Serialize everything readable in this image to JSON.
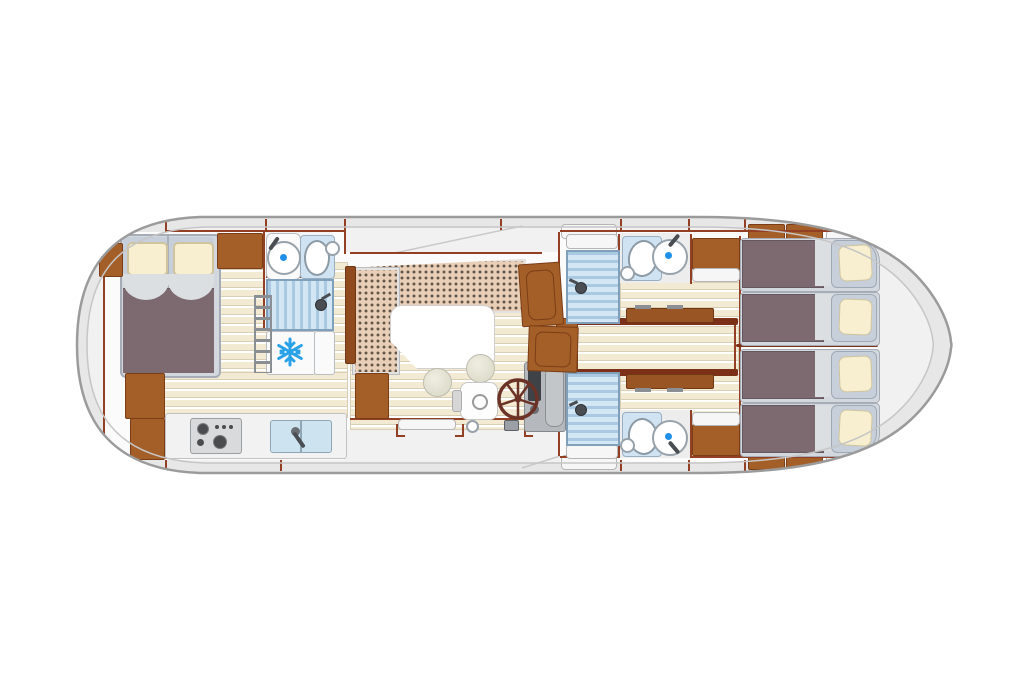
{
  "diagram": {
    "type": "boat-floor-plan",
    "title": "River cruiser interior deck plan (top view)",
    "orientation": "bow at right (pointed), stern at left (rounded)",
    "text_on_image": "none"
  },
  "palette": {
    "hull_fill": "#e7e7e7",
    "hull_stroke": "#9b9b9b",
    "deck": "#f1f1f1",
    "cabin_floor_white": "#fbfbfb",
    "wall_redbrown": "#933f24",
    "wood_cabinet": "#a45f28",
    "plank_cream": "#f3ead3",
    "sofa_upholstery": "#e9cfb8",
    "duvet_mauve": "#7c6a70",
    "pillow_cream": "#f7efcf",
    "mattress_bluegrey": "#c6cfda",
    "shower_blue": "#a9c9e3",
    "fixture_blue": "#cfe3f2",
    "accent_blue": "#1f8fe8",
    "snowflake_blue": "#2aa2e8",
    "console_grey": "#b5b8bc",
    "wheel_brown": "#6b3226"
  },
  "rooms": {
    "owner_cabin": {
      "name": "Owner cabin forward (left) with double bed, wardrobes and cabinets"
    },
    "bathroom_forward": {
      "name": "Forward bathroom with washbasin, toilet and shower"
    },
    "fridge": {
      "name": "Refrigerator with snowflake symbol"
    },
    "galley": {
      "name": "Galley with 4-burner stove and double sink"
    },
    "salon": {
      "name": "Salon with L-shaped dinette sofa, table and two stools"
    },
    "helm": {
      "name": "Inside helm station with steering wheel, console and swivel seat"
    },
    "corridor_aft": {
      "name": "Central aft corridor between the two rear cabins"
    },
    "cabin_aft_top": {
      "name": "Aft cabin (top) with fold table and two single beds"
    },
    "cabin_aft_bottom": {
      "name": "Aft cabin (bottom) with fold table and two single beds"
    },
    "bathroom_aft_top": {
      "name": "Aft bathroom (top) with shower, toilet and washbasin"
    },
    "bathroom_aft_bottom": {
      "name": "Aft bathroom (bottom) with shower, toilet and washbasin"
    },
    "stern_beds": {
      "name": "Four single beds at the pointed end, two per cabin"
    },
    "cockpit": {
      "name": "Open side deck / entry with steps at bottom centre"
    }
  },
  "icons": [
    "snowflake-fridge-icon",
    "steering-wheel-icon",
    "stove-burners-icon",
    "sink-faucet-icon",
    "shower-head-icon",
    "toilet-icon",
    "washbasin-icon",
    "ladder-steps-icon"
  ],
  "counts": {
    "double_beds": 1,
    "single_beds": 4,
    "bathrooms": 3,
    "showers": 3,
    "toilets": 3,
    "washbasins": 3,
    "stools": 2
  }
}
